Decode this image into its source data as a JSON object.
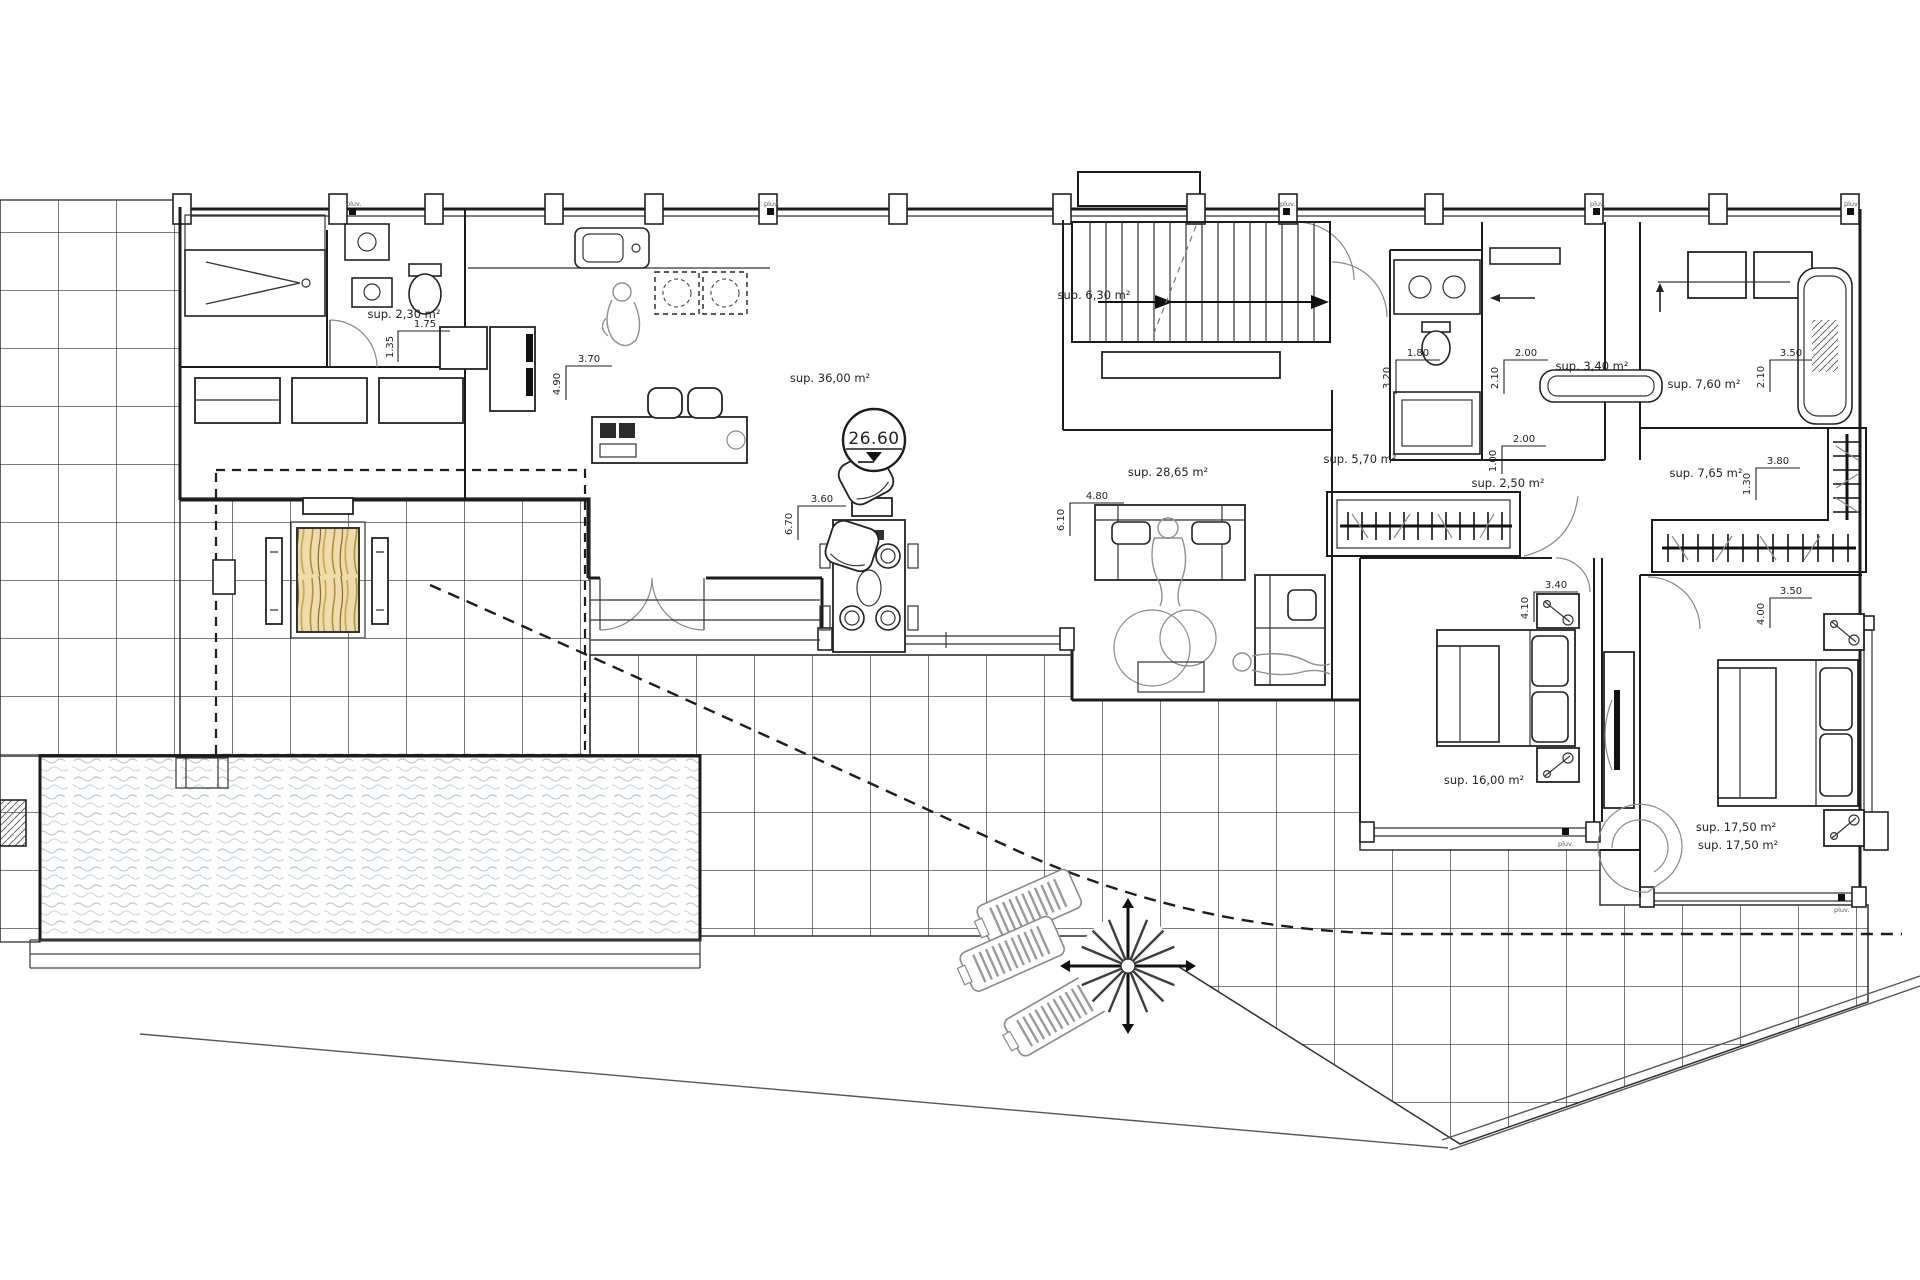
{
  "meta": {
    "drawing_type": "villa main floor plan"
  },
  "level_marker": {
    "value": "26.60"
  },
  "areas": {
    "utility_wc": "sup. 2,30 m²",
    "kitchen_living": "sup. 36,00 m²",
    "stairs": "sup. 6,30 m²",
    "lounge": "sup. 28,65 m²",
    "hall": "sup. 5,70 m²",
    "bathroom_a": "sup. 3,40 m²",
    "bathroom_b": "sup. 7,60 m²",
    "hall_closet": "sup. 2,50 m²",
    "dressing": "sup. 7,65 m²",
    "bedroom_1": "sup. 16,00 m²",
    "bedroom_2_line1": "sup. 17,50 m²",
    "bedroom_2_line2": "sup. 17,50 m²"
  },
  "dimensions": {
    "wc_w": "1.75",
    "wc_h": "1.35",
    "kitchen_w": "3.70",
    "kitchen_h": "4.90",
    "dining_w": "3.60",
    "dining_h": "6.70",
    "lounge_w": "4.80",
    "lounge_h": "6.10",
    "bath_a_w": "1.80",
    "bath_a_h": "3.20",
    "bath_b_w": "2.00",
    "bath_b_h": "2.10",
    "bath_c_w": "3.50",
    "bath_c_h": "2.10",
    "closet_w": "2.00",
    "closet_h": "1.00",
    "dressing_w": "3.80",
    "dressing_h": "1.30",
    "bedroom_1_w": "3.40",
    "bedroom_1_h": "4.10",
    "bedroom_2_w": "3.50",
    "bedroom_2_h": "4.00"
  },
  "markers": {
    "drain": "pluv."
  },
  "colors": {
    "ink": "#1f1f1f",
    "water": "#b9c7d1",
    "wood": "#d9b96d",
    "wood_grain": "#8d6b1e",
    "paper": "#ffffff",
    "soft_gray": "#8a8a8a"
  }
}
